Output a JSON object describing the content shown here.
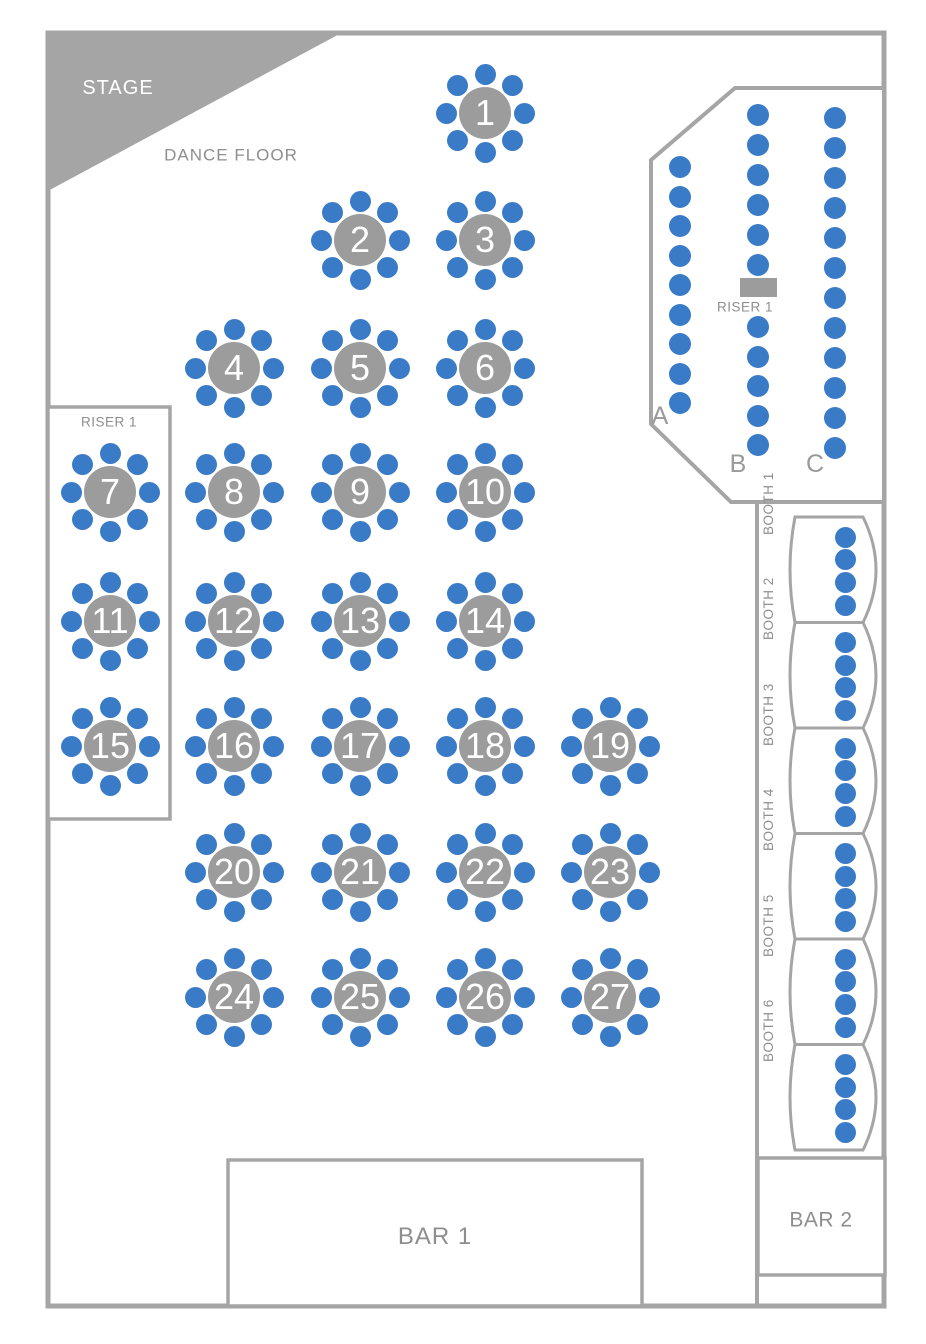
{
  "colors": {
    "seat_blue": "#3A7BC8",
    "structure_gray": "#A5A5A5",
    "table_gray": "#9C9C9C",
    "label_gray": "#8E8E8E"
  },
  "stage": {
    "label": "STAGE"
  },
  "dance_floor": {
    "label": "DANCE FLOOR"
  },
  "left_riser": {
    "label": "RISER 1"
  },
  "theater": {
    "riser_label": "RISER 1",
    "riser_platform": {
      "x": 740,
      "y": 278,
      "w": 37,
      "h": 19
    },
    "rows": [
      {
        "label": "A",
        "x": 680,
        "label_y": 429,
        "groups": [
          {
            "y": 167,
            "count": 9,
            "spacing": 29.5
          }
        ]
      },
      {
        "label": "B",
        "x": 758,
        "label_y": 477,
        "groups": [
          {
            "y": 115,
            "count": 6,
            "spacing": 30
          },
          {
            "y": 327,
            "count": 5,
            "spacing": 29.5
          }
        ]
      },
      {
        "label": "C",
        "x": 835,
        "label_y": 477,
        "groups": [
          {
            "y": 118,
            "count": 12,
            "spacing": 30
          }
        ]
      }
    ],
    "seat_diameter": 22
  },
  "table_style": {
    "table_diameter": 52,
    "chair_diameter": 21,
    "ring_radius": 39,
    "chair_count": 8
  },
  "tables": [
    {
      "number": "1",
      "x": 485,
      "y": 113
    },
    {
      "number": "2",
      "x": 360,
      "y": 240
    },
    {
      "number": "3",
      "x": 485,
      "y": 240
    },
    {
      "number": "4",
      "x": 234,
      "y": 368
    },
    {
      "number": "5",
      "x": 360,
      "y": 368
    },
    {
      "number": "6",
      "x": 485,
      "y": 368
    },
    {
      "number": "7",
      "x": 110,
      "y": 492
    },
    {
      "number": "8",
      "x": 234,
      "y": 492
    },
    {
      "number": "9",
      "x": 360,
      "y": 492
    },
    {
      "number": "10",
      "x": 485,
      "y": 492
    },
    {
      "number": "11",
      "x": 110,
      "y": 621
    },
    {
      "number": "12",
      "x": 234,
      "y": 621
    },
    {
      "number": "13",
      "x": 360,
      "y": 621
    },
    {
      "number": "14",
      "x": 485,
      "y": 621
    },
    {
      "number": "15",
      "x": 110,
      "y": 746
    },
    {
      "number": "16",
      "x": 234,
      "y": 746
    },
    {
      "number": "17",
      "x": 360,
      "y": 746
    },
    {
      "number": "18",
      "x": 485,
      "y": 746
    },
    {
      "number": "19",
      "x": 610,
      "y": 746
    },
    {
      "number": "20",
      "x": 234,
      "y": 872
    },
    {
      "number": "21",
      "x": 360,
      "y": 872
    },
    {
      "number": "22",
      "x": 485,
      "y": 872
    },
    {
      "number": "23",
      "x": 610,
      "y": 872
    },
    {
      "number": "24",
      "x": 234,
      "y": 997
    },
    {
      "number": "25",
      "x": 360,
      "y": 997
    },
    {
      "number": "26",
      "x": 485,
      "y": 997
    },
    {
      "number": "27",
      "x": 610,
      "y": 997
    }
  ],
  "booths": [
    {
      "label": "BOOTH 1"
    },
    {
      "label": "BOOTH 2"
    },
    {
      "label": "BOOTH 3"
    },
    {
      "label": "BOOTH 4"
    },
    {
      "label": "BOOTH 5"
    },
    {
      "label": "BOOTH 6"
    }
  ],
  "booth_layout": {
    "top": 517,
    "height": 105.5,
    "x_left": 795,
    "x_right": 863,
    "left_ctrl": 785,
    "right_ctrl": 889,
    "dots_x": 845,
    "dot_offsets": [
      20,
      42.7,
      65.4,
      88
    ],
    "seat_diameter": 21,
    "label_x": 817
  },
  "bars": [
    {
      "label": "BAR 1"
    },
    {
      "label": "BAR 2"
    }
  ]
}
